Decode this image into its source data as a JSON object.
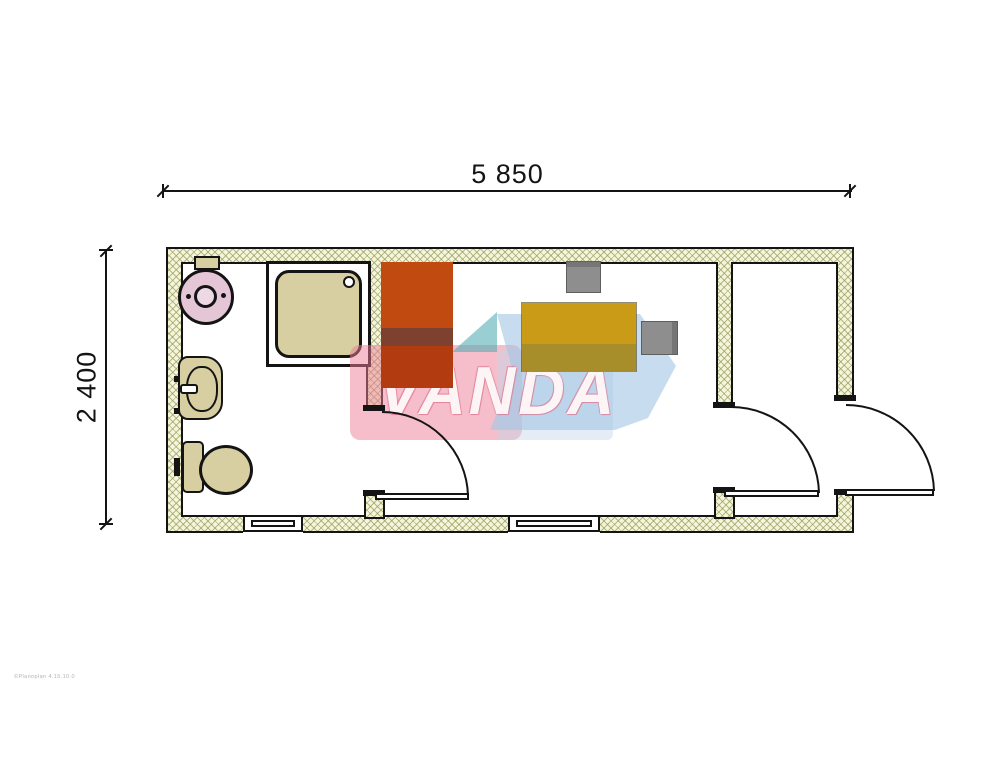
{
  "title": "container-office-floor-plan",
  "dimensions": {
    "width_label": "5 850",
    "height_label": "2 400"
  },
  "watermark": {
    "text": "VANDA",
    "caption": "©Planoplan 4.15.10.0"
  },
  "plan": {
    "rooms": [
      {
        "name": "bathroom",
        "fixtures": [
          "water-heater",
          "washbasin",
          "toilet",
          "shower-tray"
        ]
      },
      {
        "name": "office",
        "furniture": [
          "wardrobe",
          "desk",
          "chair",
          "chair"
        ]
      },
      {
        "name": "entry-room",
        "furniture": []
      }
    ],
    "door_count": 3,
    "window_count": 2
  },
  "colors": {
    "outline": "#141414",
    "wall_fill": "#f4f5dc",
    "wall_hatch_line": "rgba(146,150,80,0.65)",
    "fixture_tan": "#d7cfa1",
    "heater_pink": "#e5c6d6",
    "heater_pink_light": "#edd9e4",
    "wardrobe_top": "#c14a10",
    "wardrobe_band": "#7e4130",
    "wardrobe_bottom": "#b23c0f",
    "desk_top": "#ca9b17",
    "desk_bottom": "#a78e2a",
    "chair_gray": "#8e8e8e",
    "chair_gray_dark": "#767676",
    "wm_pink": "rgba(236,126,150,0.5)",
    "wm_pink_pale": "rgba(196,216,236,0.45)",
    "wm_blue": "rgba(164,198,228,0.62)",
    "wm_teal": "rgba(80,170,178,0.58)"
  }
}
